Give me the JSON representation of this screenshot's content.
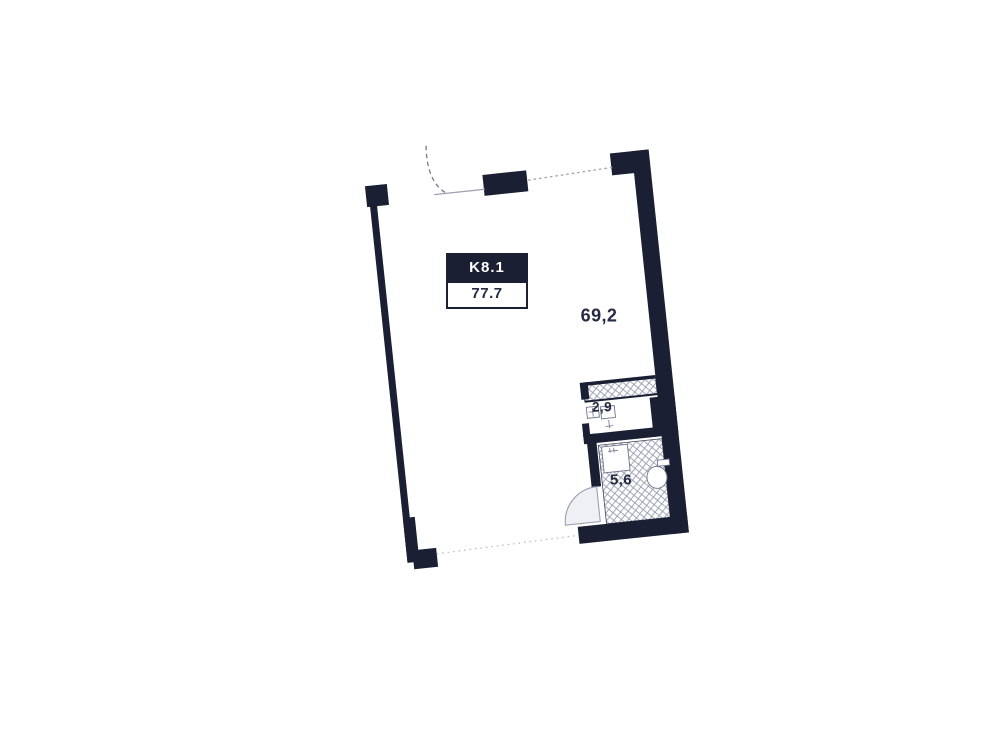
{
  "plan": {
    "unit_label": "K8.1",
    "total_area": "77.7",
    "rooms": [
      {
        "id": "living",
        "area_label": "69,2"
      },
      {
        "id": "hall",
        "area_label": "2,9"
      },
      {
        "id": "bathroom",
        "area_label": "5,6"
      }
    ],
    "colors": {
      "wall": "#1a1f33",
      "hatch_line": "#939aac",
      "hatch_outline": "#3c4257",
      "fixture_line": "#6d748a",
      "label_box_bg": "#1a1f33",
      "label_box_text": "#ffffff",
      "area_text": "#252b42",
      "faint_line": "#9ba1b1",
      "door_fill": "#eef0f4",
      "door_line": "#9aa0af",
      "background": "#ffffff"
    }
  }
}
